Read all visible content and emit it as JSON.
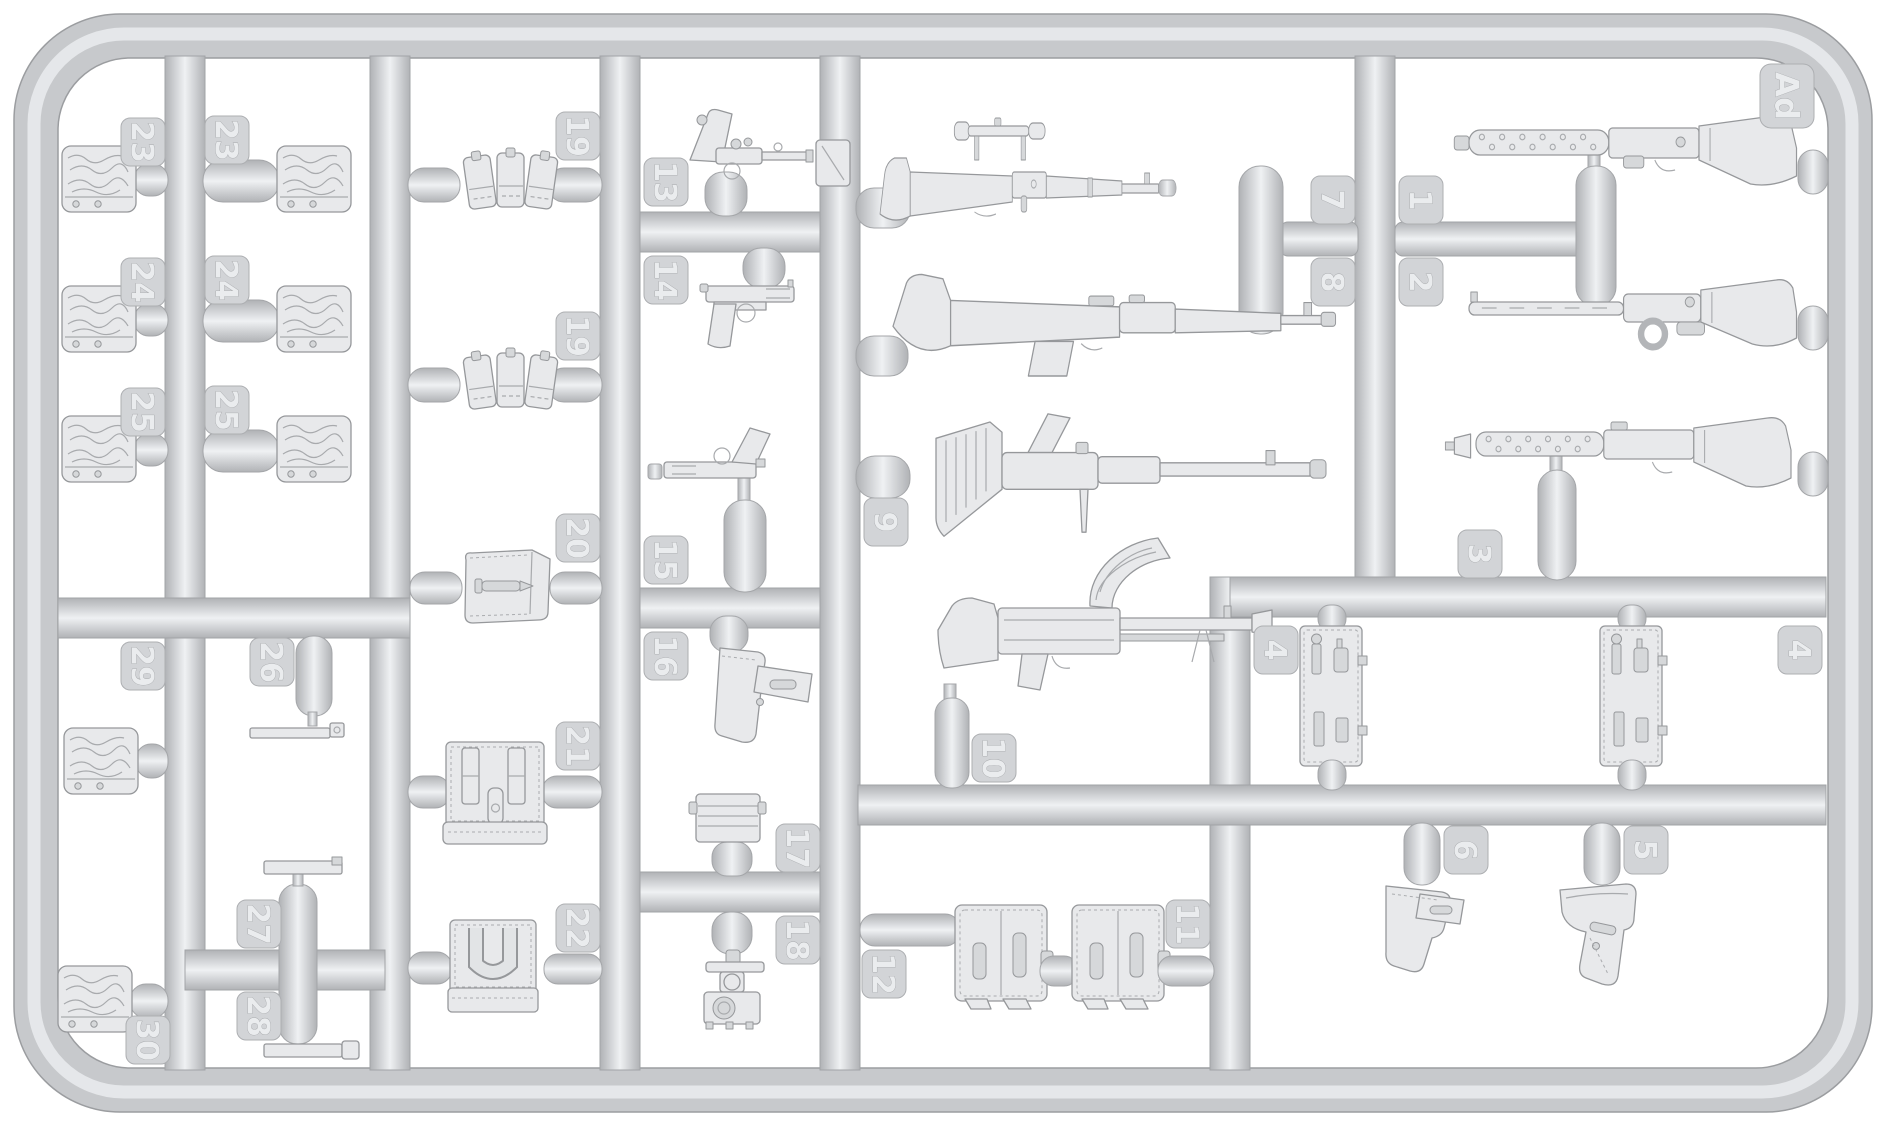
{
  "sprue": {
    "code": "Ad",
    "material_color": "#cdd0d3",
    "background_color": "#ffffff",
    "description": "Light gray injection-molded plastic sprue of 1/35 scale weapon and equipment parts"
  },
  "parts": [
    {
      "tag": "23",
      "name": "folded-shelter-quarter-left"
    },
    {
      "tag": "24",
      "name": "folded-shelter-quarter-left"
    },
    {
      "tag": "25",
      "name": "folded-shelter-quarter-left"
    },
    {
      "tag": "29",
      "name": "small-kit-bag"
    },
    {
      "tag": "30",
      "name": "small-kit-bag"
    },
    {
      "tag": "23",
      "name": "folded-shelter-quarter-right"
    },
    {
      "tag": "24",
      "name": "folded-shelter-quarter-right"
    },
    {
      "tag": "25",
      "name": "folded-shelter-quarter-right"
    },
    {
      "tag": "26",
      "name": "cleaning-rod"
    },
    {
      "tag": "27",
      "name": "equipment-strap"
    },
    {
      "tag": "28",
      "name": "equipment-strap-with-buckle"
    },
    {
      "tag": "19",
      "name": "triple-magazine-pouch"
    },
    {
      "tag": "19",
      "name": "triple-magazine-pouch"
    },
    {
      "tag": "20",
      "name": "canvas-pouch-with-tool"
    },
    {
      "tag": "21",
      "name": "bread-bag"
    },
    {
      "tag": "22",
      "name": "gas-cape-pouch"
    },
    {
      "tag": "13",
      "name": "luger-p08-long-barrel-pistol-with-stock-board"
    },
    {
      "tag": "14",
      "name": "browning-hi-power-pistol"
    },
    {
      "tag": "15",
      "name": "m1911-pistol"
    },
    {
      "tag": "16",
      "name": "pistol-holster"
    },
    {
      "tag": "17",
      "name": "ammunition-box"
    },
    {
      "tag": "18",
      "name": "optical-sight-assembly"
    },
    {
      "tag": "7",
      "name": "kar98k-sniper-rifle-with-scope"
    },
    {
      "tag": "8",
      "name": "gewehr-43-rifle"
    },
    {
      "tag": "9",
      "name": "fg42-automatic-rifle"
    },
    {
      "tag": "10",
      "name": "zb-26-light-machine-gun"
    },
    {
      "tag": "12",
      "name": "canvas-satchel"
    },
    {
      "tag": "11",
      "name": "canvas-satchel"
    },
    {
      "tag": "1",
      "name": "mp28-submachine-gun"
    },
    {
      "tag": "2",
      "name": "submachine-gun-with-slotted-barrel"
    },
    {
      "tag": "3",
      "name": "mp34-submachine-gun"
    },
    {
      "tag": "4",
      "name": "tool-panel-left"
    },
    {
      "tag": "4",
      "name": "tool-panel-right"
    },
    {
      "tag": "6",
      "name": "p38-holster"
    },
    {
      "tag": "5",
      "name": "p08-holster"
    }
  ]
}
